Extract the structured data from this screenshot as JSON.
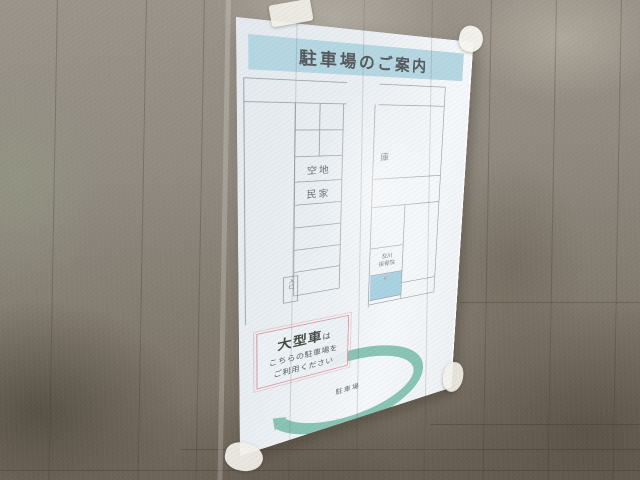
{
  "sign": {
    "title": "駐車場のご案内",
    "map_labels": {
      "vacant": "空地",
      "house": "民家",
      "storage": "庫",
      "clinic_line1": "及川",
      "clinic_line2": "接骨院",
      "entrance": "入口",
      "arc_label": "駐車場"
    },
    "notice": {
      "emphasis": "大型車",
      "particle": "は",
      "line2": "こちらの駐車場を",
      "line3": "ご利用ください"
    }
  },
  "colors": {
    "banner_blue": "#b5d7e2",
    "arrow_teal": "#7fbfae",
    "highlight_blue": "#a9d3e2",
    "notice_border_red": "#dc9aa0",
    "paper_white": "#ebf0f4",
    "wall_gray": "#8d8780",
    "map_line_gray": "#8f96a0",
    "text_dark": "#54585c"
  }
}
